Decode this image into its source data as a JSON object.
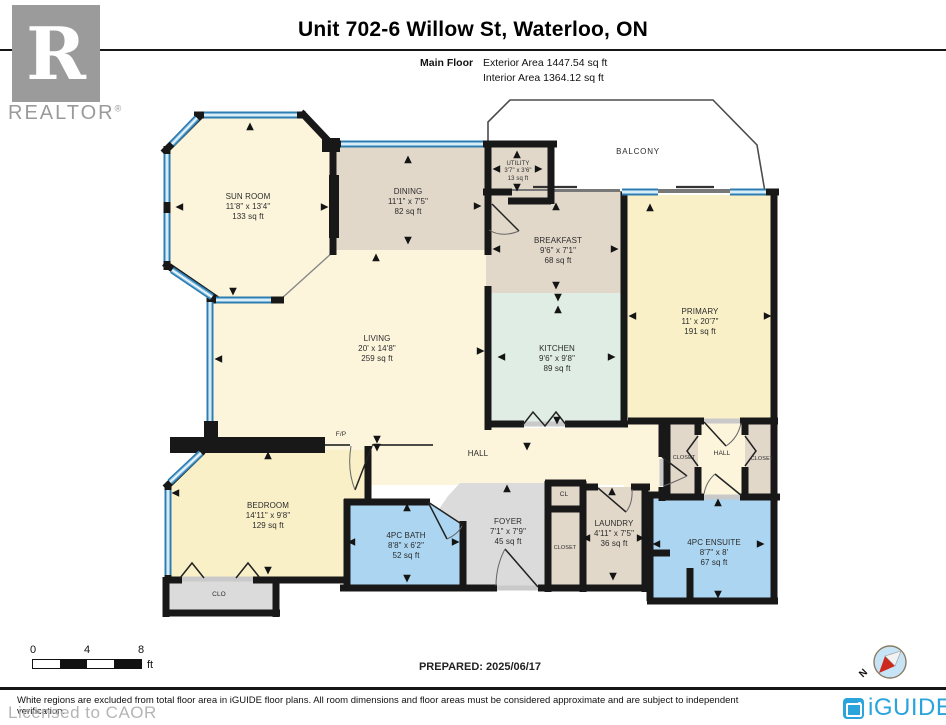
{
  "header": {
    "realtor_r": "R",
    "realtor_word": "REALTOR",
    "registered": "®",
    "title": "Unit 702-6 Willow St, Waterloo, ON",
    "floor_label": "Main Floor",
    "exterior_area": "Exterior Area 1447.54 sq ft",
    "interior_area": "Interior Area 1364.12 sq ft"
  },
  "rooms": {
    "sun_room": {
      "name": "SUN ROOM",
      "dims": "11'8\" x 13'4\"",
      "area": "133 sq ft"
    },
    "dining": {
      "name": "DINING",
      "dims": "11'1\" x 7'5\"",
      "area": "82 sq ft"
    },
    "utility": {
      "name": "UTILITY",
      "dims": "3'7\" x 3'6\"",
      "area": "13 sq ft"
    },
    "balcony": {
      "name": "BALCONY"
    },
    "breakfast": {
      "name": "BREAKFAST",
      "dims": "9'6\" x 7'1\"",
      "area": "68 sq ft"
    },
    "primary": {
      "name": "PRIMARY",
      "dims": "11' x 20'7\"",
      "area": "191 sq ft"
    },
    "living": {
      "name": "LIVING",
      "dims": "20' x 14'8\"",
      "area": "259 sq ft"
    },
    "kitchen": {
      "name": "KITCHEN",
      "dims": "9'6\" x 9'8\"",
      "area": "89 sq ft"
    },
    "hall_main": {
      "name": "HALL"
    },
    "fp": {
      "name": "F/P"
    },
    "closet_left": {
      "name": "CLOSET"
    },
    "hall_primary": {
      "name": "HALL"
    },
    "closet_right": {
      "name": "CLOSET"
    },
    "bedroom": {
      "name": "BEDROOM",
      "dims": "14'11\" x 9'8\"",
      "area": "129 sq ft"
    },
    "clo": {
      "name": "CLO"
    },
    "bath": {
      "name": "4PC BATH",
      "dims": "8'8\" x 6'2\"",
      "area": "52 sq ft"
    },
    "foyer": {
      "name": "FOYER",
      "dims": "7'1\" x 7'9\"",
      "area": "45 sq ft"
    },
    "cl": {
      "name": "CL"
    },
    "closet_foyer": {
      "name": "CLOSET"
    },
    "laundry": {
      "name": "LAUNDRY",
      "dims": "4'11\" x 7'5\"",
      "area": "36 sq ft"
    },
    "ensuite": {
      "name": "4PC ENSUITE",
      "dims": "8'7\" x 8'",
      "area": "67 sq ft"
    }
  },
  "footer": {
    "scale_0": "0",
    "scale_4": "4",
    "scale_8": "8",
    "scale_unit": "ft",
    "prepared": "PREPARED: 2025/06/17",
    "compass_n": "N",
    "disclaimer": "White regions are excluded from total floor area in iGUIDE floor plans. All room dimensions and floor areas must be considered approximate and are subject to independent verification.",
    "licensed": "Licensed to CAOR",
    "brand": "iGUIDE"
  },
  "colors": {
    "wall": "#181818",
    "window_blue": "#2E7CB0",
    "floor_cream": "#FCF5DC",
    "floor_yellow": "#FAF0C8",
    "floor_tan": "#E2D8CA",
    "floor_mint": "#DFEDE4",
    "floor_blue": "#ABD5F0",
    "floor_gray": "#DBDBDB",
    "brand_blue": "#2BA4DB",
    "compass_red": "#CC2A1E"
  }
}
